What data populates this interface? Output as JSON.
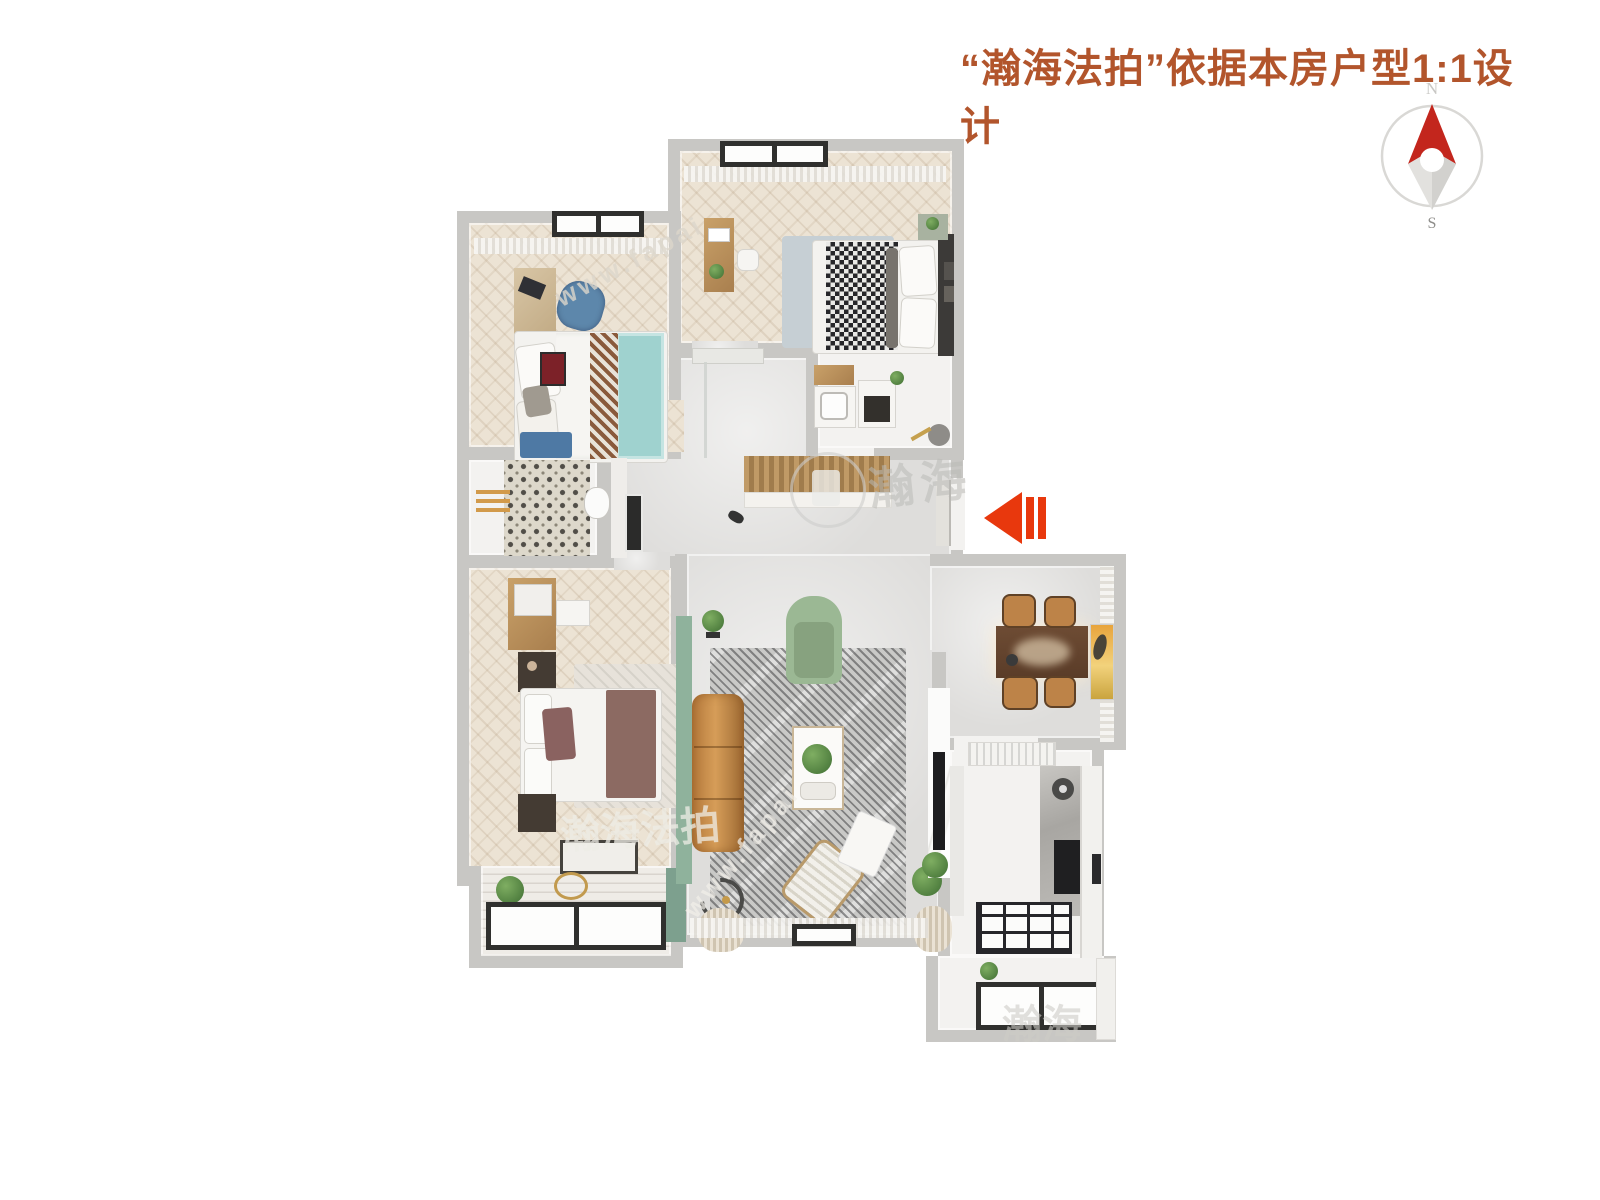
{
  "header": {
    "title": "“瀚海法拍”依据本房户型1:1设计",
    "color": "#b2552c"
  },
  "compass": {
    "north": "N",
    "south": "S",
    "needle_color": "#c3261d"
  },
  "entry_arrow": {
    "direction": "left",
    "color": "#e8380d"
  },
  "watermarks": {
    "brand_short": "瀚海",
    "brand": "瀚海法拍",
    "url_fragment": "www.fapai"
  },
  "palette": {
    "wall": "#c8c7c4",
    "bedroom_floor": "#ece3d4",
    "hall_floor": "#dedddb",
    "accent_green_wall": "#8fb29c",
    "sofa_caramel": "#c08447",
    "teal_bed": "#9fd2cf"
  }
}
